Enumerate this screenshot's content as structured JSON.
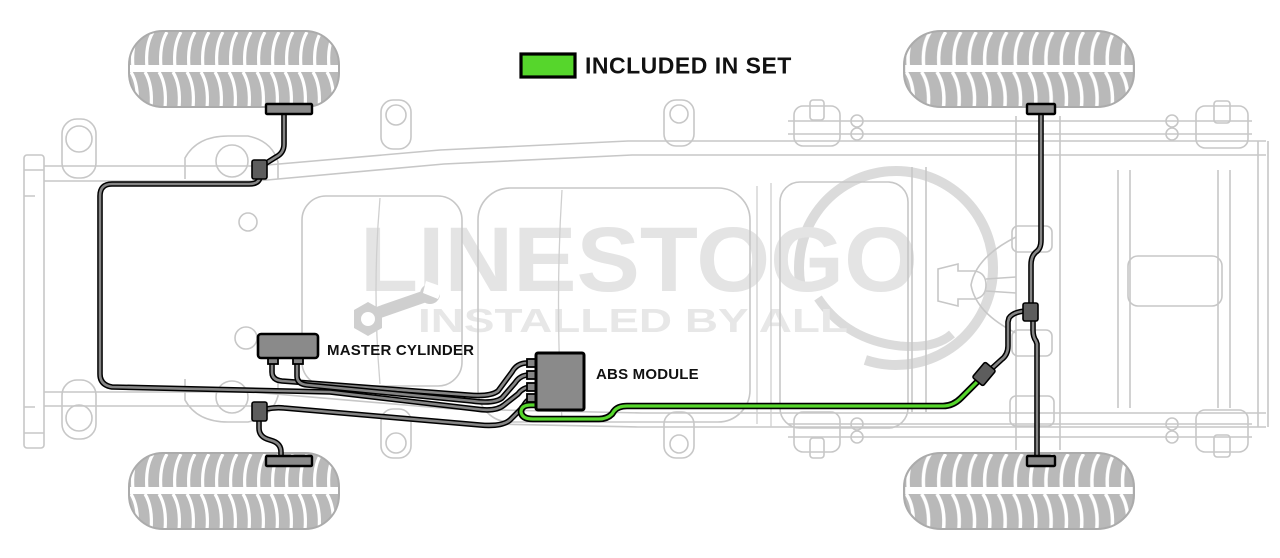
{
  "legend": {
    "label": "INCLUDED IN SET",
    "swatch_color": "#56d62c"
  },
  "component_labels": {
    "master_cylinder": "MASTER CYLINDER",
    "abs_module": "ABS MODULE"
  },
  "watermark": {
    "brand": "LINESTOGO",
    "tagline": "INSTALLED BY ALL"
  },
  "colors": {
    "included_line_green": "#56d62c",
    "brake_line_gray": "#858585",
    "line_outline_black": "#000000",
    "component_fill_gray": "#8a8a8a",
    "fitting_gray": "#5d5d5d",
    "chassis_gray": "#c7c7c7",
    "watermark_gray": "#e4e4e4"
  }
}
